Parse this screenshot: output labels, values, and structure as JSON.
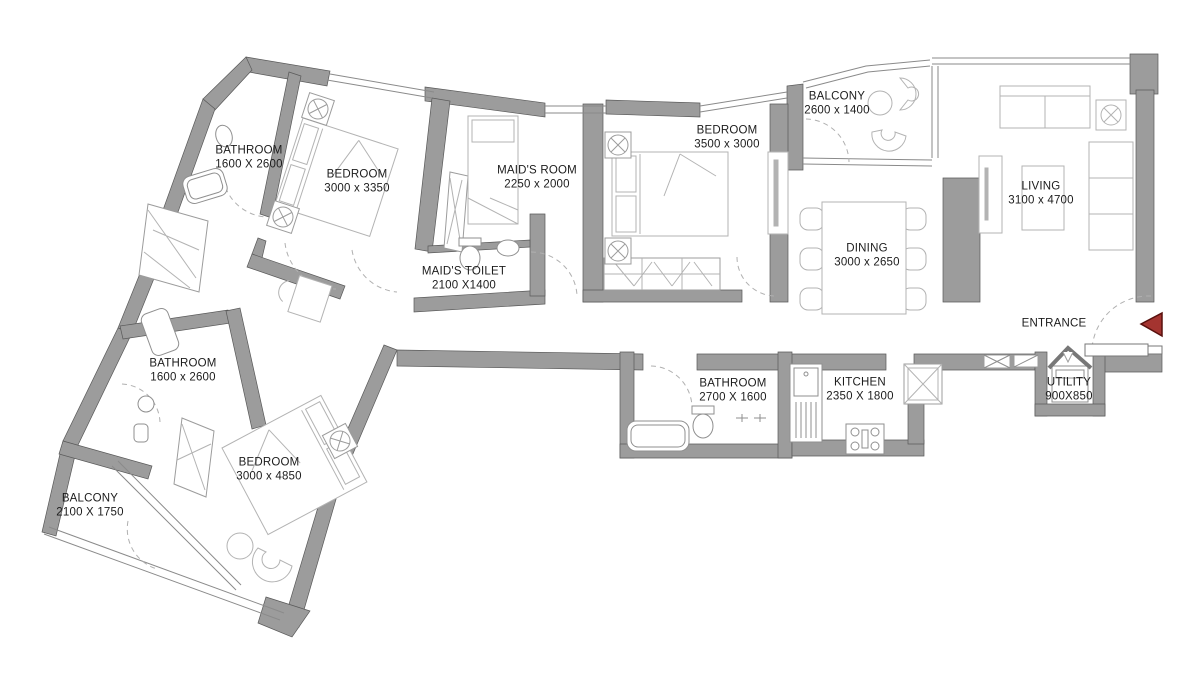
{
  "plan_title": "Apartment Floor Plan",
  "rooms": [
    {
      "id": "bathroom-1",
      "name": "BATHROOM",
      "dims": "1600 X 2600"
    },
    {
      "id": "bedroom-1",
      "name": "BEDROOM",
      "dims": "3000 x 3350"
    },
    {
      "id": "maids-room",
      "name": "MAID'S ROOM",
      "dims": "2250 x 2000"
    },
    {
      "id": "maids-toilet",
      "name": "MAID'S TOILET",
      "dims": "2100 X1400"
    },
    {
      "id": "bedroom-2",
      "name": "BEDROOM",
      "dims": "3500 x 3000"
    },
    {
      "id": "balcony-1",
      "name": "BALCONY",
      "dims": "2600 x 1400"
    },
    {
      "id": "living",
      "name": "LIVING",
      "dims": "3100 x 4700"
    },
    {
      "id": "dining",
      "name": "DINING",
      "dims": "3000 x 2650"
    },
    {
      "id": "utility",
      "name": "UTILITY",
      "dims": "900X850"
    },
    {
      "id": "kitchen",
      "name": "KITCHEN",
      "dims": "2350 X 1800"
    },
    {
      "id": "bathroom-2",
      "name": "BATHROOM",
      "dims": "2700 X 1600"
    },
    {
      "id": "bathroom-3",
      "name": "BATHROOM",
      "dims": "1600 x 2600"
    },
    {
      "id": "bedroom-3",
      "name": "BEDROOM",
      "dims": "3000 x 4850"
    },
    {
      "id": "balcony-2",
      "name": "BALCONY",
      "dims": "2100 X 1750"
    }
  ],
  "entrance": {
    "label": "ENTRANCE"
  },
  "colors": {
    "wall": "#9c9c9c",
    "wall_outline": "#595959",
    "furniture": "#b3b3b3",
    "fixture": "#8f8f8f",
    "entrance_arrow": "#a43430",
    "text": "#1c1c1c"
  }
}
